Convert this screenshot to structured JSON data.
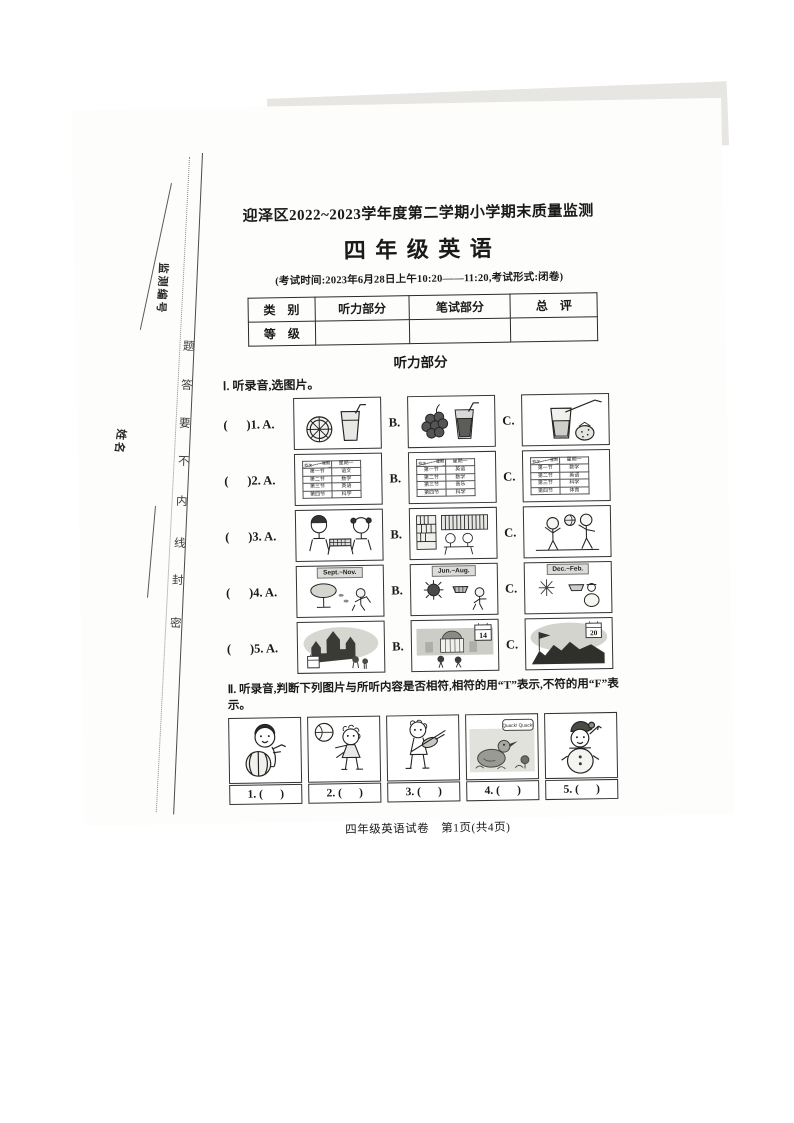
{
  "margin": {
    "monitor_no_label": "监测编号",
    "name_label": "姓名",
    "seal_chars": [
      "题",
      "答",
      "要",
      "不",
      "内",
      "线",
      "封",
      "密"
    ]
  },
  "header": {
    "title": "迎泽区2022~2023学年度第二学期小学期末质量监测",
    "subject": "四 年 级 英 语",
    "exam_info": "(考试时间:2023年6月28日上午10:20——11:20,考试形式:闭卷)"
  },
  "score_table": {
    "category": "类　别",
    "listening": "听力部分",
    "written": "笔试部分",
    "total": "总　评",
    "grade": "等　级"
  },
  "listening": {
    "section_title": "听力部分",
    "part1": {
      "instruction": "Ⅰ. 听录音,选图片。",
      "rows": [
        {
          "label": "(      )1. A.",
          "b": "B.",
          "c": "C."
        },
        {
          "label": "(      )2. A.",
          "b": "B.",
          "c": "C."
        },
        {
          "label": "(      )3. A.",
          "b": "B.",
          "c": "C."
        },
        {
          "label": "(      )4. A.",
          "b": "B.",
          "c": "C."
        },
        {
          "label": "(      )5. A.",
          "b": "B.",
          "c": "C."
        }
      ],
      "q2": {
        "week": "星期",
        "period": "节次",
        "monday": "星期一",
        "a": [
          [
            "第一节",
            "语文"
          ],
          [
            "第二节",
            "数学"
          ],
          [
            "第三节",
            "英语"
          ],
          [
            "第四节",
            "科学"
          ]
        ],
        "b": [
          [
            "第一节",
            "英语"
          ],
          [
            "第二节",
            "数学"
          ],
          [
            "第三节",
            "音乐"
          ],
          [
            "第四节",
            "科学"
          ]
        ],
        "c": [
          [
            "第一节",
            "数学"
          ],
          [
            "第二节",
            "英语"
          ],
          [
            "第三节",
            "科学"
          ],
          [
            "第四节",
            "体育"
          ]
        ]
      },
      "q4_labels": [
        "Sept.~Nov.",
        "Jun.~Aug.",
        "Dec.~Feb."
      ],
      "q5_dates": {
        "b": "14",
        "c": "20"
      }
    },
    "part2": {
      "instruction": "Ⅱ. 听录音,判断下列图片与所听内容是否相符,相符的用“T”表示,不符的用“F”表示。",
      "duck_speech": "Quack! Quack!",
      "answers": [
        "1. (      )",
        "2. (      )",
        "3. (      )",
        "4. (      )",
        "5. (      )"
      ]
    }
  },
  "footer": "四年级英语试卷　第1页(共4页)"
}
